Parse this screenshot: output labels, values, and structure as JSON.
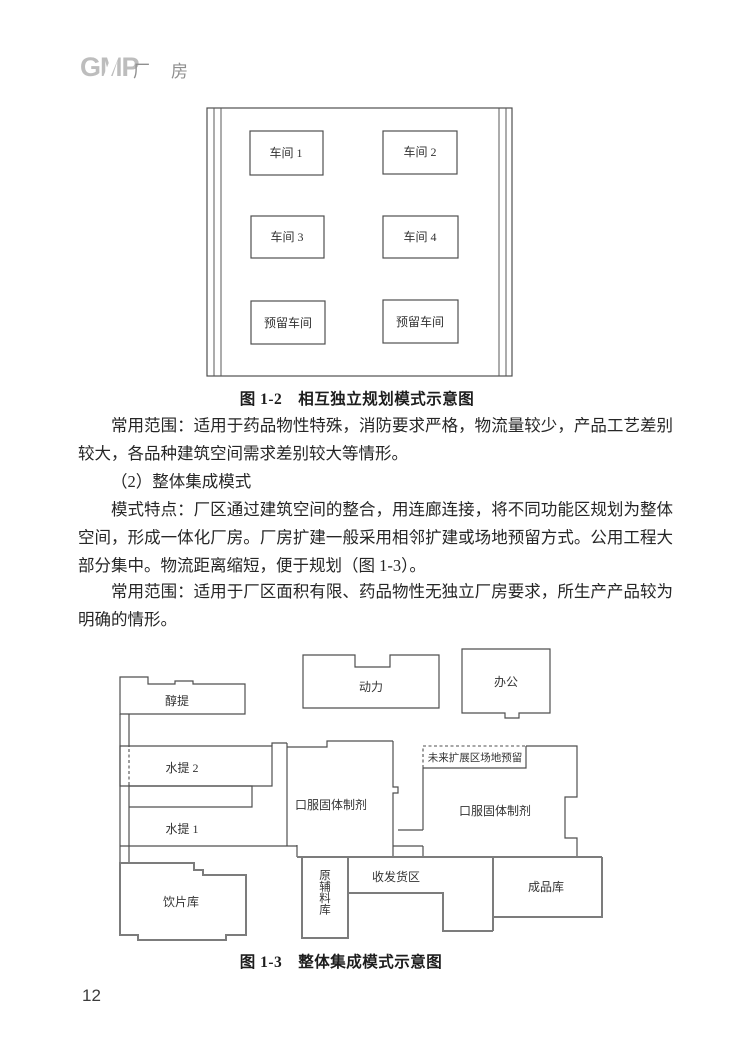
{
  "header": {
    "logo_text": "GMP",
    "page_topic": "厂　房"
  },
  "body": {
    "para_scope_1": "常用范围：适用于药品物性特殊，消防要求严格，物流量较少，产品工艺差别较大，各品种建筑空间需求差别较大等情形。",
    "heading_2": "（2）整体集成模式",
    "para_features": "模式特点：厂区通过建筑空间的整合，用连廊连接，将不同功能区规划为整体空间，形成一体化厂房。厂房扩建一般采用相邻扩建或场地预留方式。公用工程大部分集中。物流距离缩短，便于规划（图 1-3）。",
    "para_scope_2": "常用范围：适用于厂区面积有限、药品物性无独立厂房要求，所生产产品较为明确的情形。"
  },
  "figure_1_2": {
    "caption": "图 1-2　相互独立规划模式示意图",
    "rooms": {
      "workshop1": "车间 1",
      "workshop2": "车间 2",
      "workshop3": "车间 3",
      "workshop4": "车间 4",
      "reserved_left": "预留车间",
      "reserved_right": "预留车间"
    }
  },
  "figure_1_3": {
    "caption": "图 1-3　整体集成模式示意图",
    "rooms": {
      "alcohol_extraction": "醇提",
      "power": "动力",
      "office": "办公",
      "water_extraction_2": "水提 2",
      "water_extraction_1": "水提 1",
      "oral_solid_left": "口服固体制剂",
      "oral_solid_right": "口服固体制剂",
      "future_expansion": "未来扩展区场地预留",
      "decoction_pieces_warehouse": "饮片库",
      "raw_materials_warehouse": "原辅料库",
      "shipping_receiving": "收发货区",
      "finished_goods_warehouse": "成品库"
    }
  },
  "footer": {
    "page_number": "12"
  }
}
